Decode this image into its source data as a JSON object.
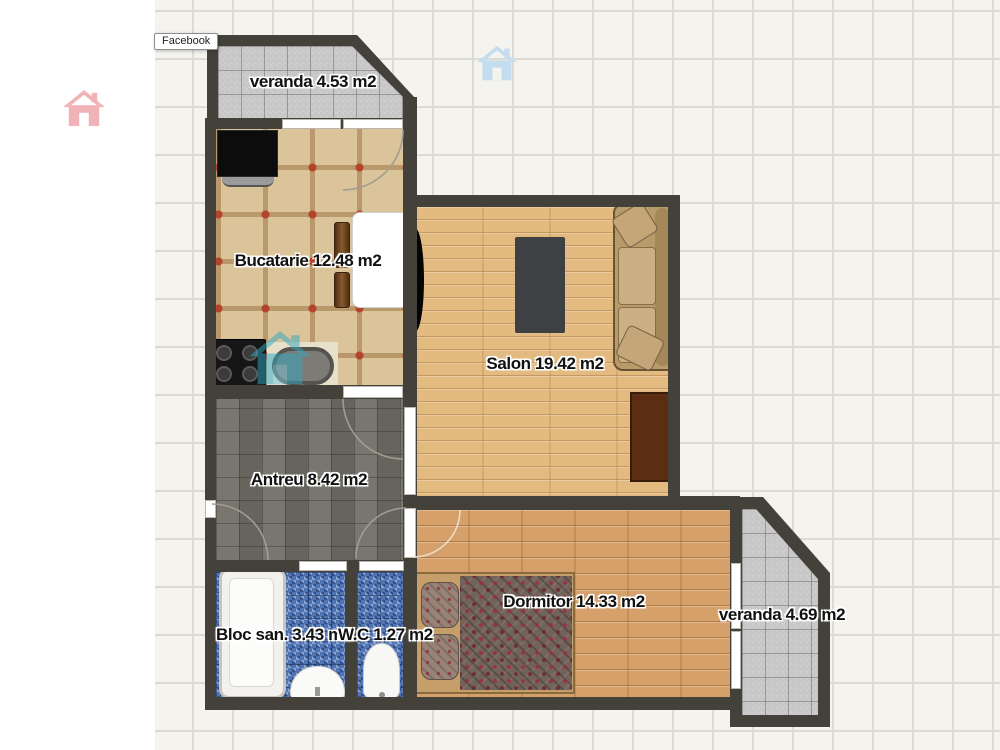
{
  "watermark_tab": {
    "label": "Facebook"
  },
  "rooms": [
    {
      "id": "veranda-top",
      "label": "veranda 4.53 m2"
    },
    {
      "id": "bucatarie",
      "label": "Bucatarie 12.48 m2"
    },
    {
      "id": "salon",
      "label": "Salon 19.42 m2"
    },
    {
      "id": "antreu",
      "label": "Antreu 8.42 m2"
    },
    {
      "id": "bloc-san",
      "label": "Bloc san. 3.43 m2"
    },
    {
      "id": "wc",
      "label": "W.C 1.27 m2"
    },
    {
      "id": "dormitor",
      "label": "Dormitor 14.33 m2"
    },
    {
      "id": "veranda-right",
      "label": "veranda 4.69 m2"
    }
  ],
  "watermarks": [
    {
      "name": "pink-house-icon",
      "color": "#f0b4b8"
    },
    {
      "name": "blue-house-icon",
      "color": "#c3ddef"
    },
    {
      "name": "teal-house-icon",
      "color": "#2fa9c4"
    }
  ],
  "objects": [
    "tv",
    "kitchen-table",
    "chair",
    "stove",
    "washbasin-tub",
    "wall-tv",
    "rug",
    "sofa",
    "tv-stand",
    "double-bed",
    "bathtub",
    "sink",
    "toilet",
    "door",
    "window"
  ],
  "colors": {
    "wall": "#44413a",
    "grid_bg": "#f4f3ee",
    "grid_line": "#dcdbd3",
    "veranda_tile": "#c7c7c7",
    "kitchen_tile": "#dcc49a",
    "kitchen_accent": "#b5432b",
    "antreu_tile": "#716d66",
    "bath_mosaic": "#4f74b5",
    "salon_wood": "#e3ba80",
    "dormitor_wood": "#d5a069",
    "label_color": "#111111",
    "pink_house": "#f0b4b8",
    "blue_house": "#c3ddef",
    "teal_house": "#2fa9c4"
  }
}
